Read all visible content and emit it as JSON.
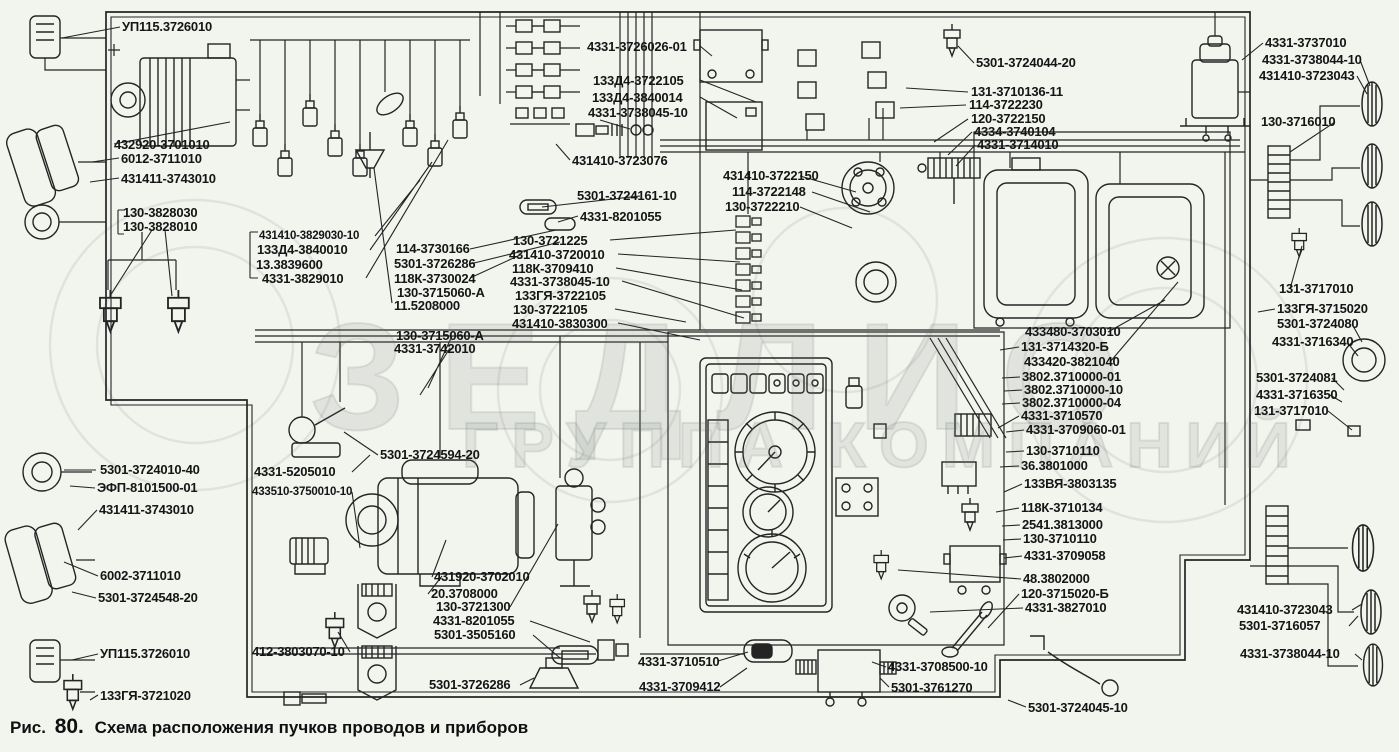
{
  "figure": {
    "prefix": "Рис.",
    "number": "80.",
    "title": "Схема расположения пучков проводов и приборов"
  },
  "watermark": {
    "word": "ЗЕДЛИО",
    "subtitle": "ГРУППА КОМПАНИЙ"
  },
  "colors": {
    "paper": "#f2f4ee",
    "ink": "#242424",
    "label_ink": "#151515"
  },
  "labels": [
    "УП115.3726010",
    "432920-3701010",
    "6012-3711010",
    "431411-3743010",
    "130-3828030",
    "130-3828010",
    "431410-3829030-10",
    "133Д4-3840010",
    "13.3839600",
    "4331-3829010",
    "114-3730166",
    "5301-3726286",
    "118К-3730024",
    "130-3715060-А",
    "11.5208000",
    "130-3715060-А",
    "4331-3742010",
    "130-3721225",
    "431410-3720010",
    "118К-3709410",
    "4331-3738045-10",
    "133ГЯ-3722105",
    "130-3722105",
    "431410-3830300",
    "4331-3726026-01",
    "133Д4-3722105",
    "133Д4-3840014",
    "4331-3738045-10",
    "431410-3723076",
    "5301-3724161-10",
    "4331-8201055",
    "431410-3722150",
    "114-3722148",
    "130-3722210",
    "5301-3724044-20",
    "131-3710136-11",
    "114-3722230",
    "120-3722150",
    "4334-3740104",
    "4331-3714010",
    "4331-3737010",
    "4331-3738044-10",
    "431410-3723043",
    "130-3716010",
    "131-3717010",
    "133ГЯ-3715020",
    "5301-3724080",
    "4331-3716340",
    "5301-3724081",
    "4331-3716350",
    "131-3717010",
    "433480-3703010",
    "131-3714320-Б",
    "433420-3821040",
    "3802.3710000-01",
    "3802.3710000-10",
    "3802.3710000-04",
    "4331-3710570",
    "4331-3709060-01",
    "130-3710110",
    "36.3801000",
    "133ВЯ-3803135",
    "118К-3710134",
    "2541.3813000",
    "130-3710110",
    "4331-3709058",
    "48.3802000",
    "120-3715020-Б",
    "4331-3827010",
    "5301-3724010-40",
    "ЭФП-8101500-01",
    "431411-3743010",
    "4331-5205010",
    "433510-3750010-10",
    "5301-3724594-20",
    "6002-3711010",
    "5301-3724548-20",
    "УП115.3726010",
    "133ГЯ-3721020",
    "412-3803070-10",
    "431920-3702010",
    "20.3708000",
    "130-3721300",
    "4331-8201055",
    "5301-3505160",
    "5301-3726286",
    "4331-3710510",
    "4331-3709412",
    "4331-3708500-10",
    "5301-3761270",
    "5301-3724045-10",
    "431410-3723043",
    "5301-3716057",
    "4331-3738044-10"
  ]
}
